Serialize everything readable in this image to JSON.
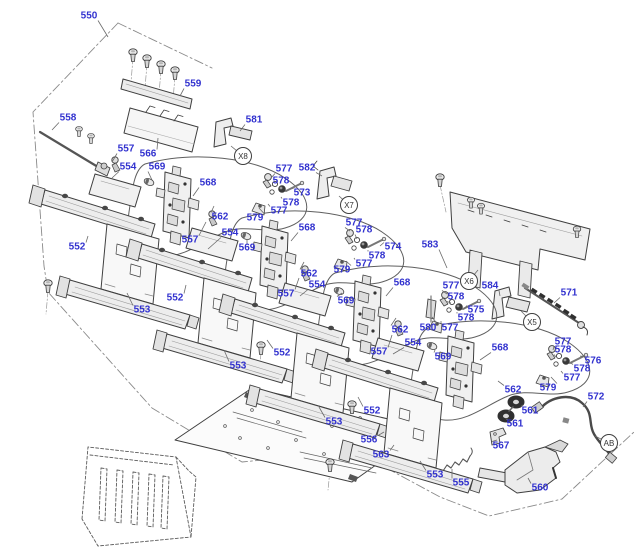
{
  "diagram": {
    "type": "exploded-parts-diagram",
    "canvas": {
      "width": 640,
      "height": 549
    },
    "colors": {
      "label_blue": "#3232cf",
      "line_dark": "#3f3f3f",
      "leader_gray": "#6b6b6b",
      "phantom_gray": "#8a8a8a",
      "background": "#ffffff"
    },
    "refs": [
      {
        "t": "X8",
        "x": 243,
        "y": 156,
        "tx": 231,
        "ty": 146
      },
      {
        "t": "X7",
        "x": 349,
        "y": 205,
        "tx": 339,
        "ty": 196
      },
      {
        "t": "X6",
        "x": 469,
        "y": 281,
        "tx": 478,
        "ty": 270
      },
      {
        "t": "X5",
        "x": 532,
        "y": 322,
        "tx": 521,
        "ty": 311
      },
      {
        "t": "AB",
        "x": 609,
        "y": 443,
        "tx": 595,
        "ty": 436
      }
    ],
    "labels": [
      {
        "t": "550",
        "x": 89,
        "y": 16,
        "tx": 108,
        "ty": 37
      },
      {
        "t": "559",
        "x": 193,
        "y": 84,
        "tx": 180,
        "ty": 96
      },
      {
        "t": "558",
        "x": 68,
        "y": 118,
        "tx": 52,
        "ty": 130
      },
      {
        "t": "581",
        "x": 254,
        "y": 120,
        "tx": 240,
        "ty": 131
      },
      {
        "t": "557",
        "x": 126,
        "y": 149,
        "tx": 112,
        "ty": 162
      },
      {
        "t": "566",
        "x": 148,
        "y": 154,
        "tx": 158,
        "ty": 138
      },
      {
        "t": "554",
        "x": 128,
        "y": 167,
        "tx": 112,
        "ty": 178
      },
      {
        "t": "569",
        "x": 157,
        "y": 167,
        "tx": 152,
        "ty": 180
      },
      {
        "t": "568",
        "x": 208,
        "y": 183,
        "tx": 193,
        "ty": 196
      },
      {
        "t": "577",
        "x": 284,
        "y": 169,
        "tx": 271,
        "ty": 178
      },
      {
        "t": "582",
        "x": 307,
        "y": 168,
        "tx": 322,
        "ty": 176
      },
      {
        "t": "578",
        "x": 281,
        "y": 181,
        "tx": 274,
        "ty": 186
      },
      {
        "t": "573",
        "x": 302,
        "y": 193,
        "tx": 293,
        "ty": 189
      },
      {
        "t": "578",
        "x": 291,
        "y": 203,
        "tx": 281,
        "ty": 197
      },
      {
        "t": "577",
        "x": 279,
        "y": 211,
        "tx": 268,
        "ty": 204
      },
      {
        "t": "579",
        "x": 255,
        "y": 218,
        "tx": 259,
        "ty": 208
      },
      {
        "t": "562",
        "x": 220,
        "y": 217,
        "tx": 214,
        "ty": 206
      },
      {
        "t": "552",
        "x": 77,
        "y": 247,
        "tx": 88,
        "ty": 236
      },
      {
        "t": "557",
        "x": 190,
        "y": 240,
        "tx": 206,
        "ty": 222
      },
      {
        "t": "554",
        "x": 230,
        "y": 233,
        "tx": 208,
        "ty": 249
      },
      {
        "t": "569",
        "x": 247,
        "y": 248,
        "tx": 247,
        "ty": 239
      },
      {
        "t": "568",
        "x": 307,
        "y": 228,
        "tx": 291,
        "ty": 241
      },
      {
        "t": "577",
        "x": 354,
        "y": 223,
        "tx": 350,
        "ty": 231
      },
      {
        "t": "578",
        "x": 364,
        "y": 230,
        "tx": 357,
        "ty": 239
      },
      {
        "t": "574",
        "x": 393,
        "y": 247,
        "tx": 380,
        "ty": 246
      },
      {
        "t": "583",
        "x": 430,
        "y": 245,
        "tx": 447,
        "ty": 268
      },
      {
        "t": "578",
        "x": 377,
        "y": 256,
        "tx": 368,
        "ty": 250
      },
      {
        "t": "577",
        "x": 364,
        "y": 264,
        "tx": 354,
        "ty": 258
      },
      {
        "t": "579",
        "x": 342,
        "y": 270,
        "tx": 346,
        "ty": 261
      },
      {
        "t": "553",
        "x": 142,
        "y": 310,
        "tx": 127,
        "ty": 293
      },
      {
        "t": "552",
        "x": 175,
        "y": 298,
        "tx": 186,
        "ty": 285
      },
      {
        "t": "562",
        "x": 309,
        "y": 274,
        "tx": 304,
        "ty": 262
      },
      {
        "t": "554",
        "x": 317,
        "y": 285,
        "tx": 300,
        "ty": 296
      },
      {
        "t": "557",
        "x": 286,
        "y": 294,
        "tx": 299,
        "ty": 278
      },
      {
        "t": "569",
        "x": 346,
        "y": 301,
        "tx": 342,
        "ty": 293
      },
      {
        "t": "568",
        "x": 402,
        "y": 283,
        "tx": 386,
        "ty": 296
      },
      {
        "t": "577",
        "x": 451,
        "y": 286,
        "tx": 447,
        "ty": 294
      },
      {
        "t": "584",
        "x": 490,
        "y": 286,
        "tx": 500,
        "ty": 296
      },
      {
        "t": "571",
        "x": 569,
        "y": 293,
        "tx": 554,
        "ty": 303
      },
      {
        "t": "578",
        "x": 456,
        "y": 297,
        "tx": 451,
        "ty": 303
      },
      {
        "t": "575",
        "x": 476,
        "y": 310,
        "tx": 464,
        "ty": 309
      },
      {
        "t": "578",
        "x": 466,
        "y": 318,
        "tx": 457,
        "ty": 312
      },
      {
        "t": "580",
        "x": 428,
        "y": 328,
        "tx": 432,
        "ty": 317
      },
      {
        "t": "577",
        "x": 450,
        "y": 328,
        "tx": 441,
        "ty": 321
      },
      {
        "t": "562",
        "x": 400,
        "y": 330,
        "tx": 396,
        "ty": 318
      },
      {
        "t": "552",
        "x": 282,
        "y": 353,
        "tx": 267,
        "ty": 340
      },
      {
        "t": "553",
        "x": 238,
        "y": 366,
        "tx": 224,
        "ty": 350
      },
      {
        "t": "554",
        "x": 413,
        "y": 343,
        "tx": 393,
        "ty": 354
      },
      {
        "t": "557",
        "x": 379,
        "y": 352,
        "tx": 392,
        "ty": 335
      },
      {
        "t": "568",
        "x": 500,
        "y": 348,
        "tx": 480,
        "ty": 360
      },
      {
        "t": "577",
        "x": 563,
        "y": 342,
        "tx": 553,
        "ty": 350
      },
      {
        "t": "578",
        "x": 563,
        "y": 350,
        "tx": 556,
        "ty": 357
      },
      {
        "t": "569",
        "x": 443,
        "y": 357,
        "tx": 435,
        "ty": 350
      },
      {
        "t": "576",
        "x": 593,
        "y": 361,
        "tx": 580,
        "ty": 356
      },
      {
        "t": "578",
        "x": 582,
        "y": 369,
        "tx": 571,
        "ty": 363
      },
      {
        "t": "577",
        "x": 572,
        "y": 378,
        "tx": 561,
        "ty": 371
      },
      {
        "t": "562",
        "x": 513,
        "y": 390,
        "tx": 498,
        "ty": 381
      },
      {
        "t": "579",
        "x": 548,
        "y": 388,
        "tx": 551,
        "ty": 377
      },
      {
        "t": "572",
        "x": 596,
        "y": 397,
        "tx": 583,
        "ty": 407
      },
      {
        "t": "552",
        "x": 372,
        "y": 411,
        "tx": 358,
        "ty": 397
      },
      {
        "t": "561",
        "x": 530,
        "y": 411,
        "tx": 523,
        "ty": 405
      },
      {
        "t": "553",
        "x": 334,
        "y": 422,
        "tx": 319,
        "ty": 407
      },
      {
        "t": "561",
        "x": 515,
        "y": 424,
        "tx": 508,
        "ty": 419
      },
      {
        "t": "556",
        "x": 369,
        "y": 440,
        "tx": 384,
        "ty": 432
      },
      {
        "t": "567",
        "x": 501,
        "y": 446,
        "tx": 497,
        "ty": 440
      },
      {
        "t": "563",
        "x": 381,
        "y": 455,
        "tx": 394,
        "ty": 445
      },
      {
        "t": "553",
        "x": 435,
        "y": 475,
        "tx": 420,
        "ty": 461
      },
      {
        "t": "555",
        "x": 461,
        "y": 483,
        "tx": 452,
        "ty": 469
      },
      {
        "t": "560",
        "x": 540,
        "y": 488,
        "tx": 528,
        "ty": 478
      }
    ]
  }
}
